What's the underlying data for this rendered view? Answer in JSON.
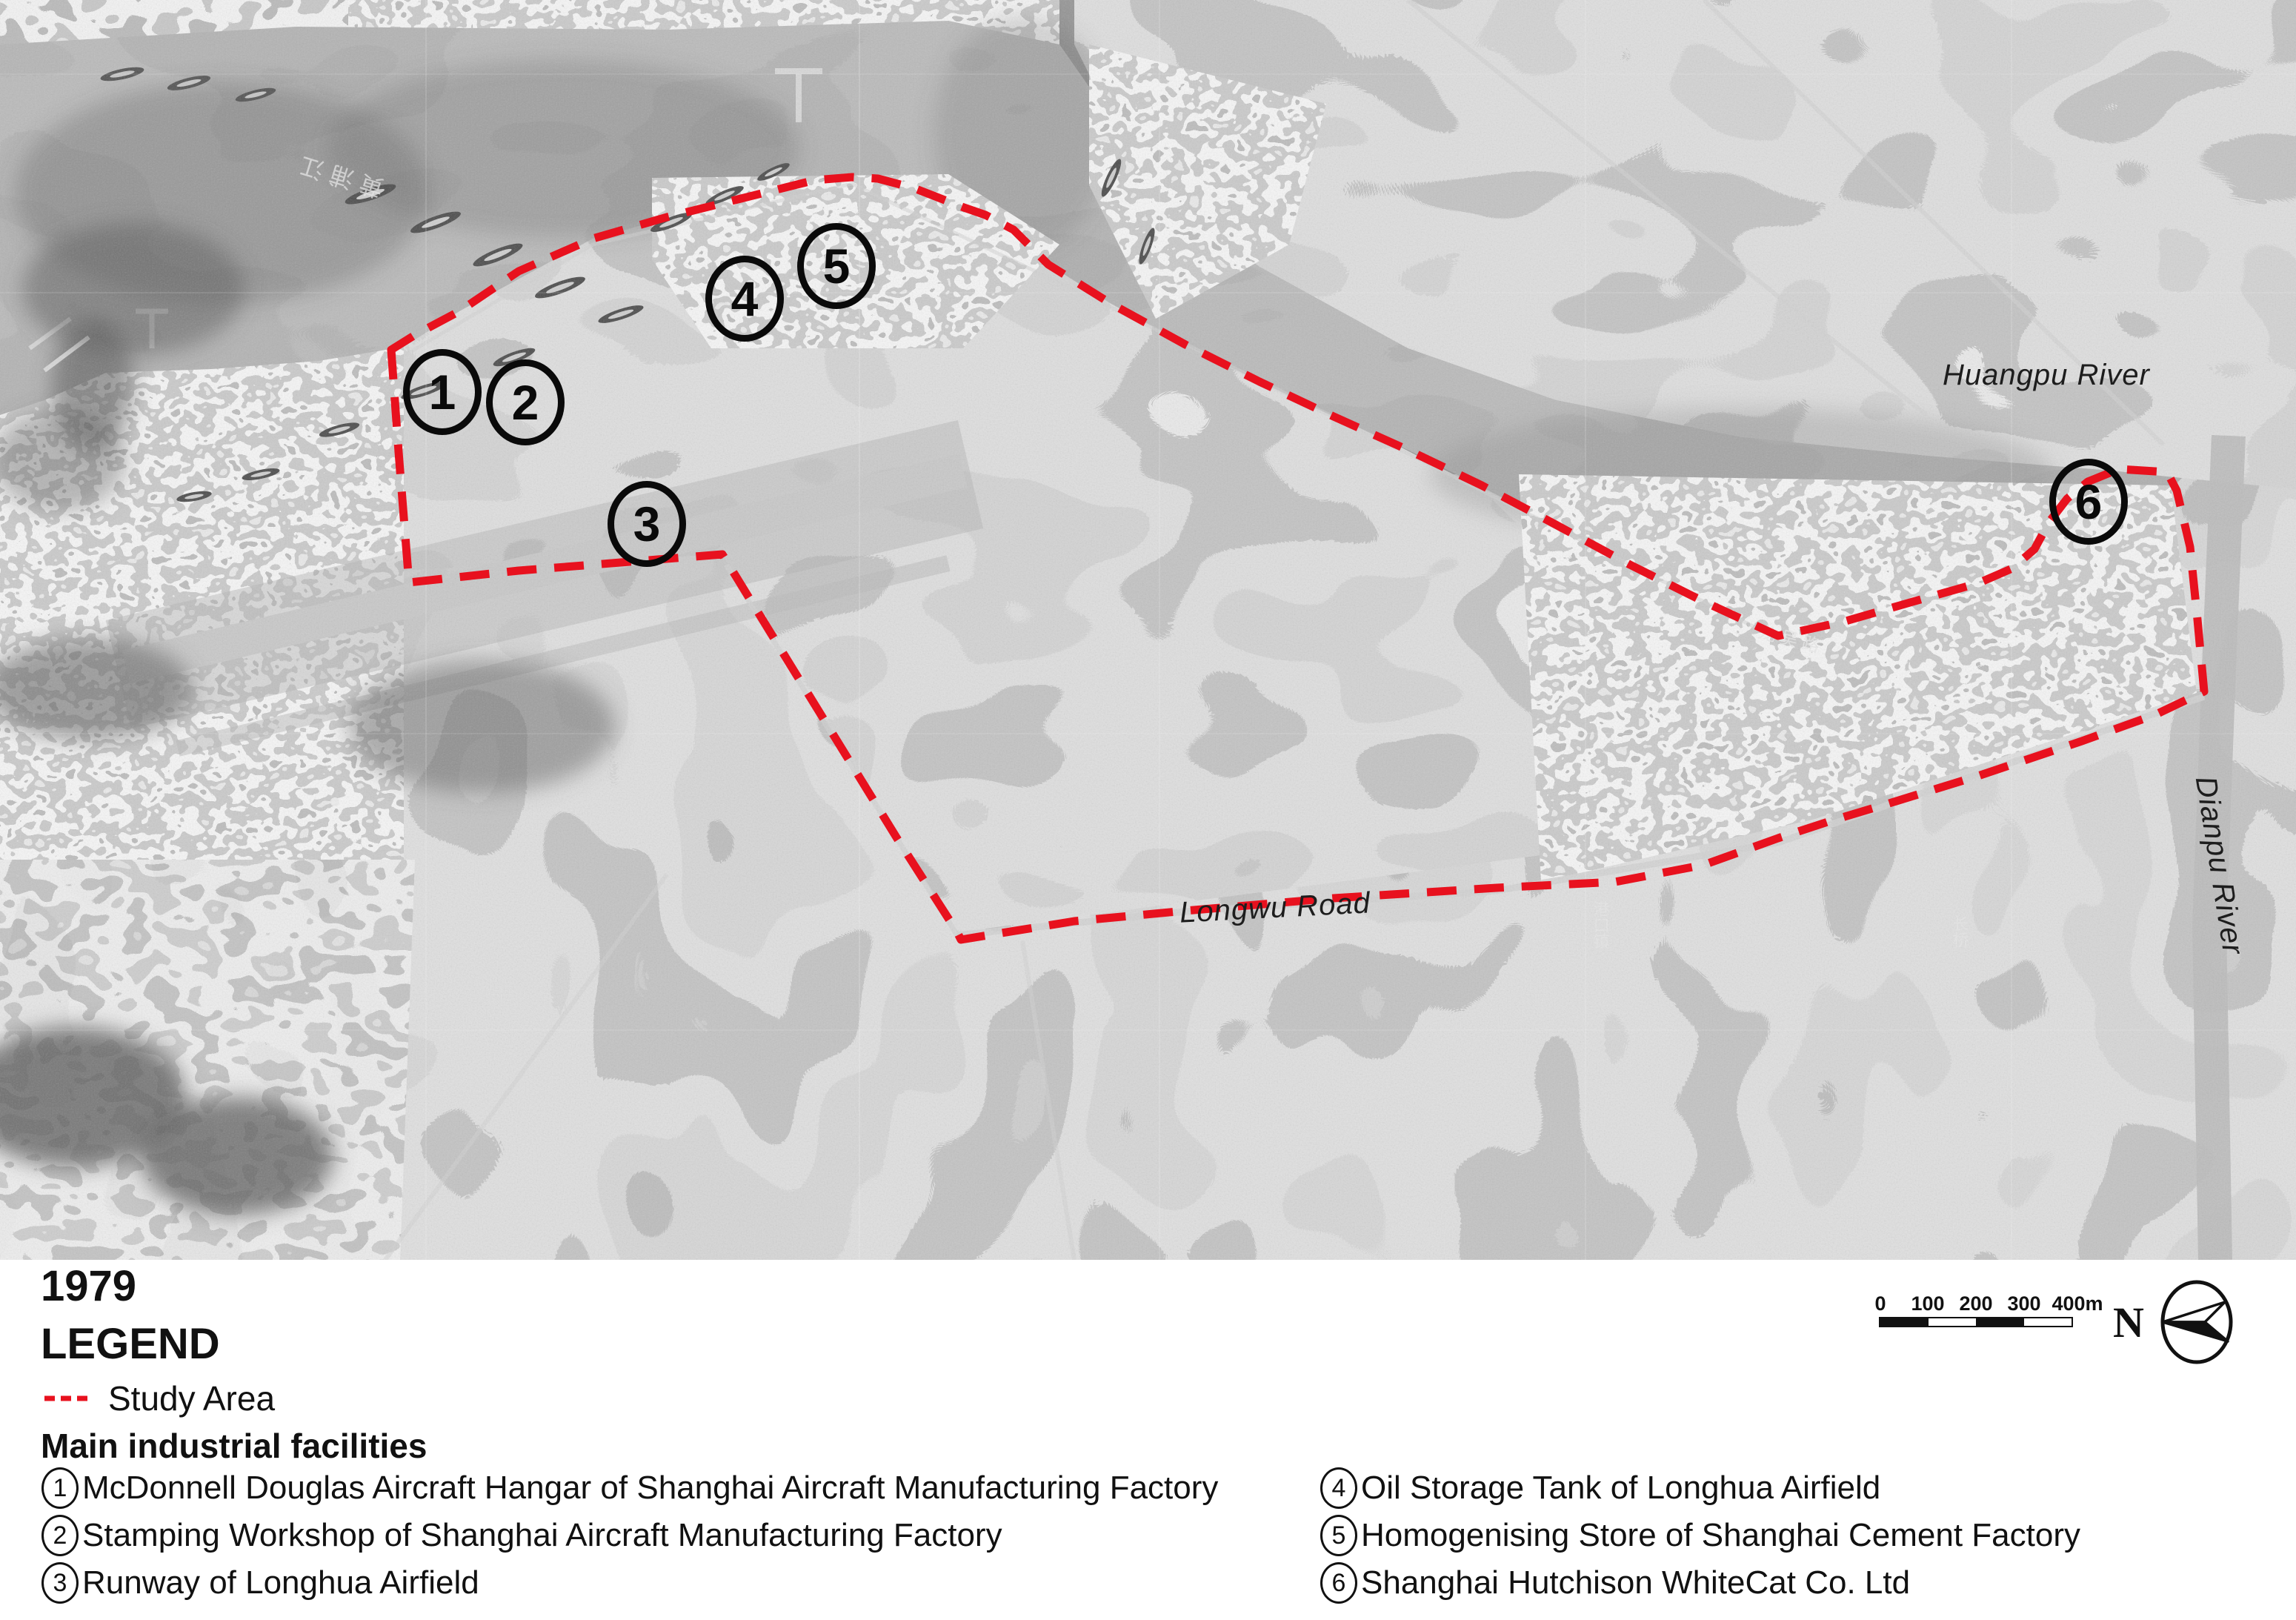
{
  "map": {
    "labels": {
      "huangpu_river": "Huangpu River",
      "dianpu_river": "Dianpu River",
      "longwu_road": "Longwu Road"
    },
    "markers": [
      "1",
      "2",
      "3",
      "4",
      "5",
      "6"
    ],
    "photo_annotations": {
      "river_glyphs": "黄浦江",
      "road_glyphs": "龙吴路",
      "town_glyphs": "港口镇",
      "bridge_glyphs": "长桥"
    },
    "study_area_color": "#e8111e"
  },
  "legend": {
    "year_title": "1979",
    "title": "LEGEND",
    "study_area_label": "Study Area",
    "facilities_heading": "Main industrial facilities",
    "facilities": [
      {
        "num": "1",
        "label": "McDonnell Douglas Aircraft Hangar of Shanghai Aircraft Manufacturing Factory"
      },
      {
        "num": "2",
        "label": "Stamping Workshop of Shanghai Aircraft Manufacturing Factory"
      },
      {
        "num": "3",
        "label": "Runway of Longhua Airfield"
      },
      {
        "num": "4",
        "label": "Oil Storage Tank of Longhua Airfield"
      },
      {
        "num": "5",
        "label": "Homogenising Store of Shanghai Cement Factory"
      },
      {
        "num": "6",
        "label": "Shanghai Hutchison WhiteCat Co. Ltd"
      }
    ]
  },
  "scale_bar": {
    "ticks": [
      "0",
      "100",
      "200",
      "300",
      "400m"
    ]
  },
  "north_arrow": {
    "label": "N"
  }
}
